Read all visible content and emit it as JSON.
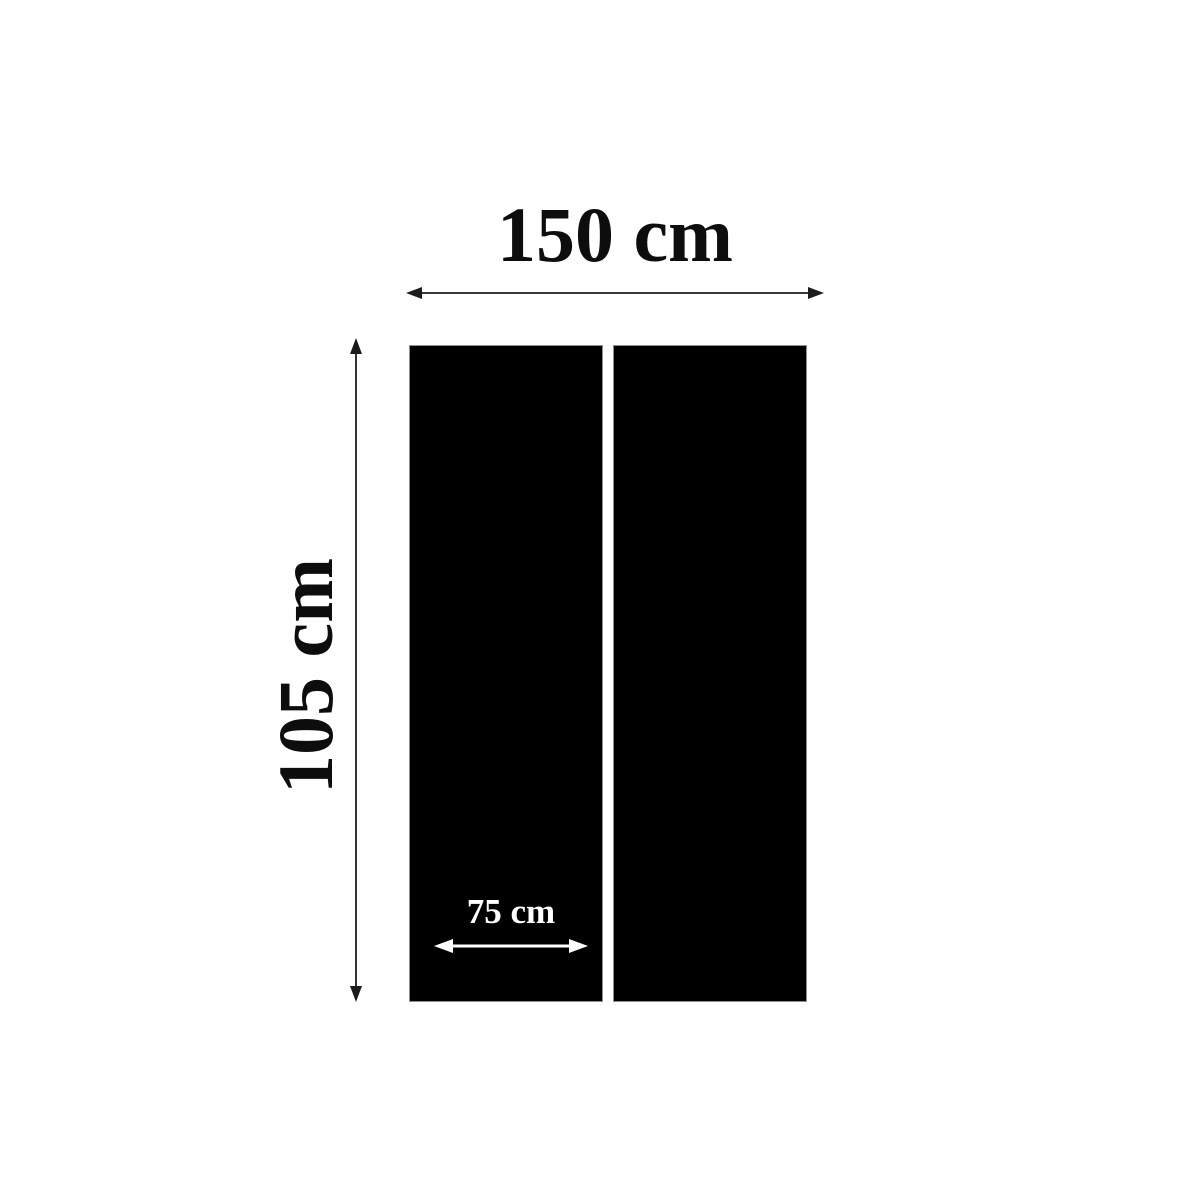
{
  "diagram": {
    "dimensions": {
      "total_width_label": "150 cm",
      "height_label": "105 cm",
      "panel_width_label": "75 cm"
    },
    "panels": [
      {
        "name": "left-panel"
      },
      {
        "name": "right-panel"
      }
    ],
    "colors": {
      "background": "#ffffff",
      "panel": "#000000",
      "panel_border": "#8f8f8f",
      "dimension_arrow": "#1c1c1c",
      "dimension_text": "#0d0d0d",
      "inner_arrow": "#ffffff",
      "inner_text": "#ffffff"
    }
  }
}
